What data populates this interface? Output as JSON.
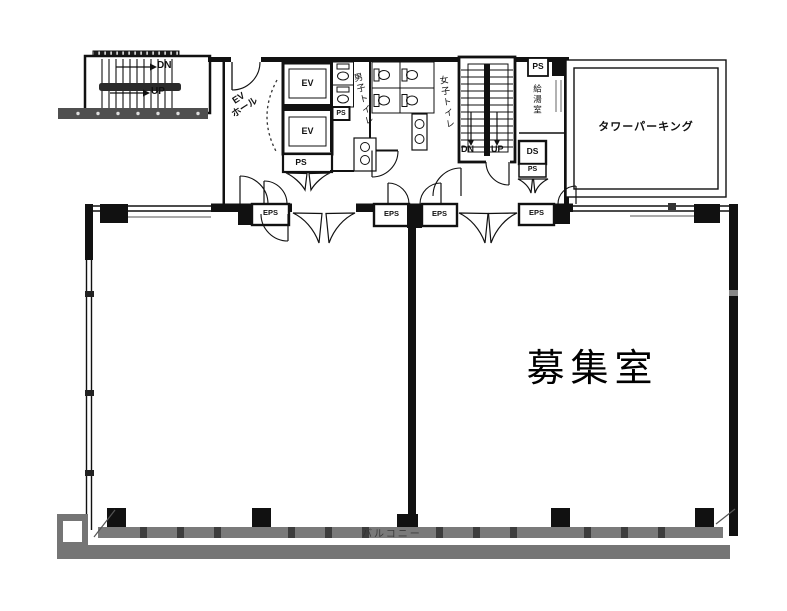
{
  "floor_plan": {
    "exterior_stair": {
      "dn": "DN",
      "up": "UP"
    },
    "elevator_hall": {
      "label": "EV\nホール"
    },
    "elevators": {
      "ev_top": "EV",
      "ev_bottom": "EV",
      "ps": "PS"
    },
    "toilets": {
      "mens": "男子トイレ",
      "womens": "女子トイレ",
      "ps": "PS"
    },
    "interior_stair": {
      "dn": "DN",
      "up": "UP"
    },
    "utility": {
      "ps_top": "PS",
      "kitchenette": "給湯室",
      "ds": "DS",
      "ps_bottom": "PS"
    },
    "parking": {
      "label": "タワーパーキング"
    },
    "eps_shafts": [
      "EPS",
      "EPS",
      "EPS",
      "EPS"
    ],
    "room": {
      "label": "募集室"
    },
    "balcony": {
      "label": "バルコニー"
    },
    "colors": {
      "wall": "#111111",
      "balcony": "#757575",
      "window_band": "#7a7a7a"
    }
  }
}
